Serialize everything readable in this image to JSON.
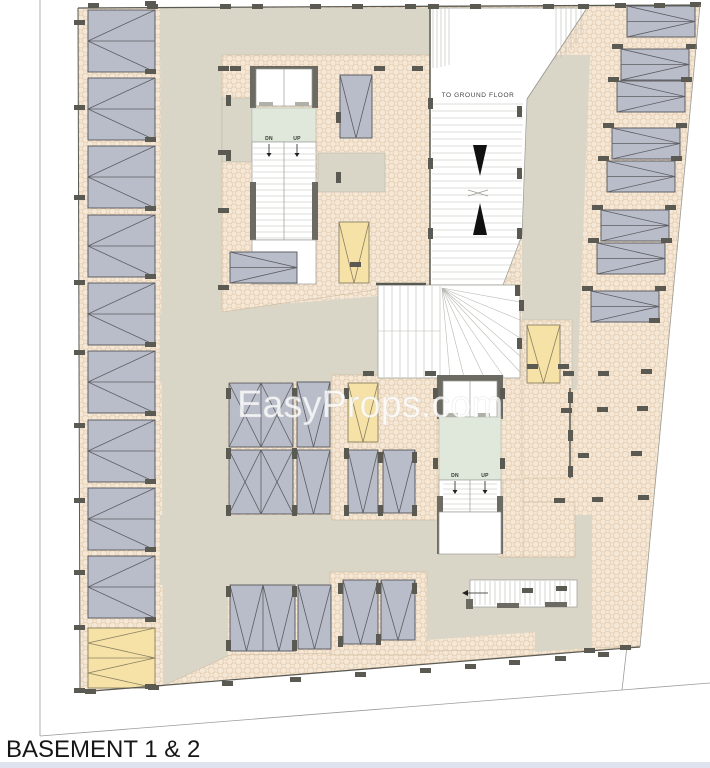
{
  "page": {
    "footer_strip_color": "#dee3ef"
  },
  "plan": {
    "title": "BASEMENT 1 & 2",
    "watermark": "EasyProps.com",
    "ramp_label": "TO GROUND FLOOR",
    "stairs": {
      "down_label": "DN",
      "up_label": "UP"
    },
    "colors": {
      "aisle": "#d9d5c7",
      "apron": "#f5e8d6",
      "apron_dot": "#e6cfb4",
      "stall_gray": "#b9bdc9",
      "stall_yellow": "#f6e2a7",
      "stall_border": "#55565a",
      "lobby_green": "#dfe8da",
      "wall_dark": "#6b6b63",
      "marker": "#5a5a52",
      "boundary": "#9b9b9b"
    }
  }
}
